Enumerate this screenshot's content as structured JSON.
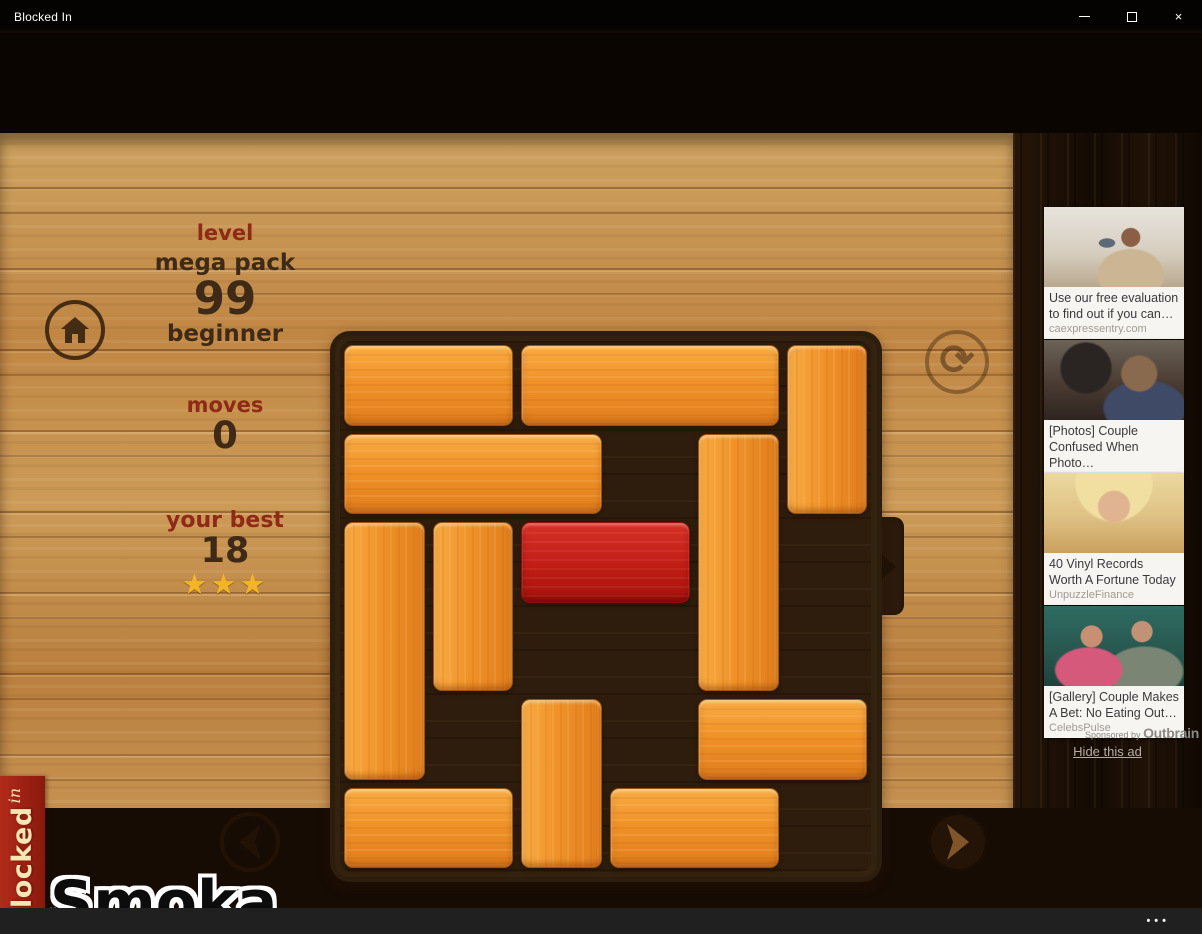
{
  "window": {
    "title": "Blocked In",
    "close_glyph": "×"
  },
  "appbar": {
    "more": "•••"
  },
  "hud": {
    "level_label": "level",
    "pack_name": "mega pack",
    "level_number": "99",
    "difficulty": "beginner",
    "moves_label": "moves",
    "moves_value": "0",
    "best_label": "your best",
    "best_value": "18",
    "stars": 3,
    "stars_text": "★★★"
  },
  "board": {
    "rows": 6,
    "cols": 6,
    "exit": {
      "row": 2,
      "side": "right"
    },
    "blocks": [
      {
        "row": 0,
        "col": 0,
        "len": 2,
        "dir": "h",
        "type": "orange"
      },
      {
        "row": 0,
        "col": 2,
        "len": 3,
        "dir": "h",
        "type": "orange"
      },
      {
        "row": 0,
        "col": 5,
        "len": 2,
        "dir": "v",
        "type": "orange"
      },
      {
        "row": 1,
        "col": 0,
        "len": 3,
        "dir": "h",
        "type": "orange"
      },
      {
        "row": 1,
        "col": 4,
        "len": 3,
        "dir": "v",
        "type": "orange"
      },
      {
        "row": 2,
        "col": 0,
        "len": 3,
        "dir": "v",
        "type": "orange"
      },
      {
        "row": 2,
        "col": 1,
        "len": 2,
        "dir": "v",
        "type": "orange"
      },
      {
        "row": 2,
        "col": 2,
        "len": 2,
        "dir": "h",
        "type": "red"
      },
      {
        "row": 4,
        "col": 2,
        "len": 2,
        "dir": "v",
        "type": "orange"
      },
      {
        "row": 4,
        "col": 4,
        "len": 2,
        "dir": "h",
        "type": "orange"
      },
      {
        "row": 5,
        "col": 0,
        "len": 2,
        "dir": "h",
        "type": "orange"
      },
      {
        "row": 5,
        "col": 3,
        "len": 2,
        "dir": "h",
        "type": "orange"
      }
    ]
  },
  "branding": {
    "banner_word": "Blocked",
    "banner_sub": "in",
    "watermark": "Smoka"
  },
  "ads": {
    "items": [
      {
        "title": "Use our free evaluation to find out if you can…",
        "source": "caexpressentry.com"
      },
      {
        "title": "[Photos] Couple Confused When Photo…",
        "source": "CelebsPulse"
      },
      {
        "title": "40 Vinyl Records Worth A Fortune Today",
        "source": "UnpuzzleFinance"
      },
      {
        "title": "[Gallery] Couple Makes A Bet: No Eating Out…",
        "source": "CelebsPulse"
      }
    ],
    "sponsored_prefix": "Sponsored by",
    "sponsored_brand": "Outbrain",
    "hide_label": "Hide this ad"
  },
  "colors": {
    "wood_light": "#c28a4c",
    "board_dark": "#2e1d0d",
    "block_orange": "#f09228",
    "block_red": "#c01d15",
    "banner_red": "#9c2012",
    "star_gold": "#f2b428",
    "hud_maroon": "#8e2a15",
    "hud_brown": "#3e2a16"
  }
}
